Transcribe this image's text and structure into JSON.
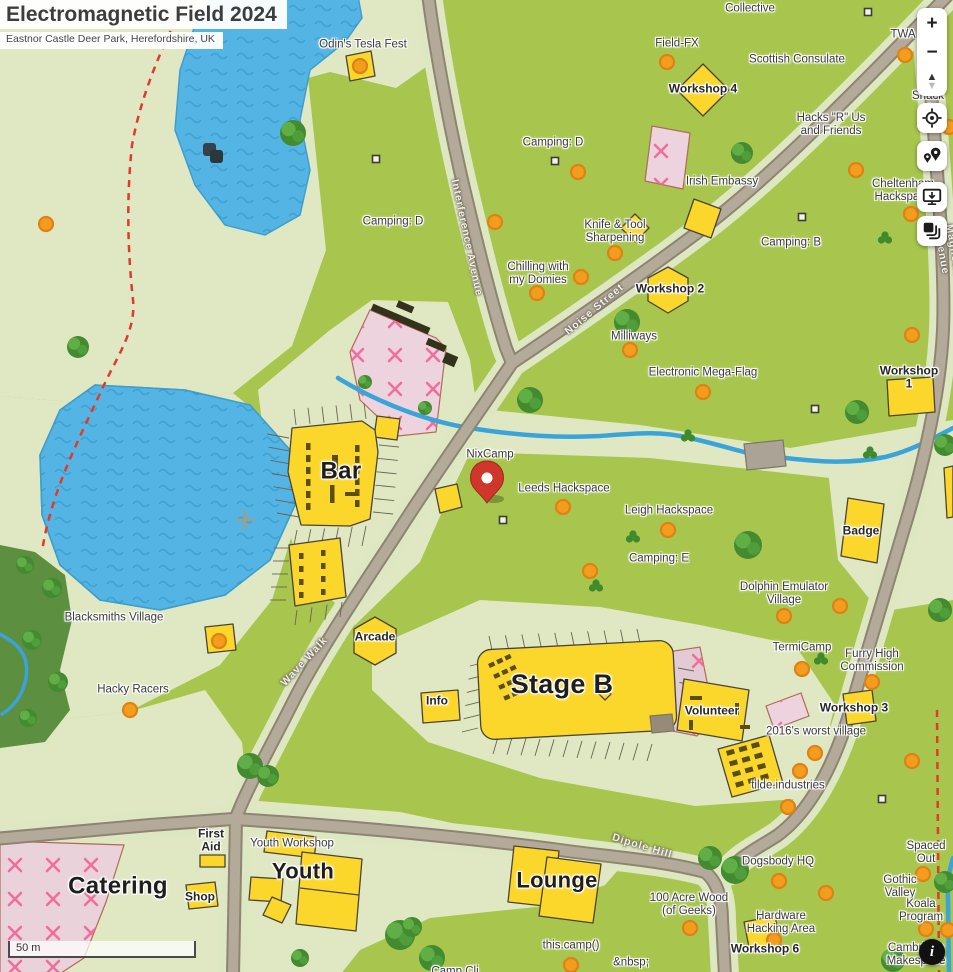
{
  "title": {
    "main": "Electromagnetic Field 2024",
    "subtitle": "Eastnor Castle Deer Park, Herefordshire, UK"
  },
  "scale_bar": {
    "label": "50 m"
  },
  "controls": {
    "zoom_in": "+",
    "zoom_out": "−",
    "compass_up": "▲",
    "compass_down": "▼",
    "locate": "locate-icon",
    "pins": "map-pins-icon",
    "export": "screen-export-icon",
    "layers": "layers-icon",
    "info": "i"
  },
  "marker": {
    "name": "red-map-pin",
    "x": 487,
    "y": 497
  },
  "colors": {
    "grass": "#a8c64d",
    "pale": "#dfe8c3",
    "water": "#54b4e4",
    "road": "#b3aa9a",
    "road_casing": "#8e8472",
    "building_yellow": "#fcd72b",
    "pink_area": "#ecd3de",
    "pink_x": "#ef6e9b",
    "orange_dot": "#f49c1e",
    "pin_red": "#ce3729",
    "red_dash": "#e2392b",
    "forest": "#5c8f3f"
  },
  "labels": [
    {
      "id": "odins-tesla-fest",
      "text": "Odin's Tesla Fest",
      "x": 363,
      "y": 45,
      "cls": "reg"
    },
    {
      "id": "collective",
      "text": "Collective",
      "x": 750,
      "y": 9,
      "cls": "reg"
    },
    {
      "id": "field-fx",
      "text": "Field-FX",
      "x": 677,
      "y": 44,
      "cls": "reg"
    },
    {
      "id": "scottish-consulate",
      "text": "Scottish Consulate",
      "x": 797,
      "y": 60,
      "cls": "reg"
    },
    {
      "id": "twa",
      "text": "TWA",
      "x": 903,
      "y": 35,
      "cls": "reg"
    },
    {
      "id": "hacks-r-us",
      "text": "Hacks \"R\" Us\nand Friends",
      "x": 831,
      "y": 125,
      "cls": "reg"
    },
    {
      "id": "shack",
      "text": "Shack (",
      "x": 928,
      "y": 103,
      "cls": "reg"
    },
    {
      "id": "camping-d-west",
      "text": "Camping: D",
      "x": 393,
      "y": 222,
      "cls": "reg"
    },
    {
      "id": "camping-d-east",
      "text": "Camping: D",
      "x": 553,
      "y": 143,
      "cls": "reg"
    },
    {
      "id": "irish-embassy",
      "text": "Irish Embassy",
      "x": 722,
      "y": 182,
      "cls": "reg"
    },
    {
      "id": "camping-b",
      "text": "Camping: B",
      "x": 791,
      "y": 243,
      "cls": "reg"
    },
    {
      "id": "knife-tool-sharpening",
      "text": "Knife & Tool\nSharpening",
      "x": 615,
      "y": 232,
      "cls": "reg"
    },
    {
      "id": "chilling-with-my-domies",
      "text": "Chilling with\nmy Domies",
      "x": 538,
      "y": 274,
      "cls": "reg"
    },
    {
      "id": "milliways",
      "text": "Milliways",
      "x": 634,
      "y": 337,
      "cls": "reg"
    },
    {
      "id": "electronic-mega-flag",
      "text": "Electronic Mega-Flag",
      "x": 703,
      "y": 373,
      "cls": "reg"
    },
    {
      "id": "cheltenham-hackspace",
      "text": "Cheltenham\nHackspace",
      "x": 903,
      "y": 191,
      "cls": "reg"
    },
    {
      "id": "nixcamp",
      "text": "NixCamp",
      "x": 490,
      "y": 455,
      "cls": "reg"
    },
    {
      "id": "leeds-hackspace",
      "text": "Leeds Hackspace",
      "x": 564,
      "y": 489,
      "cls": "reg"
    },
    {
      "id": "leigh-hackspace",
      "text": "Leigh Hackspace",
      "x": 669,
      "y": 511,
      "cls": "reg"
    },
    {
      "id": "camping-e",
      "text": "Camping: E",
      "x": 659,
      "y": 559,
      "cls": "reg"
    },
    {
      "id": "dolphin-emulator-village",
      "text": "Dolphin Emulator\nVillage",
      "x": 784,
      "y": 594,
      "cls": "reg"
    },
    {
      "id": "termicamp",
      "text": "TermiCamp",
      "x": 802,
      "y": 648,
      "cls": "reg"
    },
    {
      "id": "furry-high-commission",
      "text": "Furry High\nCommission",
      "x": 872,
      "y": 661,
      "cls": "reg"
    },
    {
      "id": "blacksmiths-village",
      "text": "Blacksmiths Village",
      "x": 114,
      "y": 618,
      "cls": "reg"
    },
    {
      "id": "hacky-racers",
      "text": "Hacky Racers",
      "x": 133,
      "y": 690,
      "cls": "reg"
    },
    {
      "id": "worst-village-2016",
      "text": "2016's worst village",
      "x": 816,
      "y": 732,
      "cls": "reg"
    },
    {
      "id": "tilde-industries",
      "text": "tilde.industries",
      "x": 788,
      "y": 786,
      "cls": "reg"
    },
    {
      "id": "dogsbody-hq",
      "text": "Dogsbody HQ",
      "x": 778,
      "y": 862,
      "cls": "reg"
    },
    {
      "id": "spaced-out",
      "text": "Spaced Out",
      "x": 926,
      "y": 853,
      "cls": "reg"
    },
    {
      "id": "gothic-valley",
      "text": "Gothic Valley",
      "x": 900,
      "y": 887,
      "cls": "reg"
    },
    {
      "id": "koala-program",
      "text": "Koala Program",
      "x": 921,
      "y": 911,
      "cls": "reg"
    },
    {
      "id": "hundred-acre-wood",
      "text": "100 Acre Wood\n(of Geeks)",
      "x": 689,
      "y": 905,
      "cls": "reg"
    },
    {
      "id": "hardware-hacking-area",
      "text": "Hardware\nHacking Area",
      "x": 781,
      "y": 923,
      "cls": "reg"
    },
    {
      "id": "this-camp",
      "text": "this.camp()",
      "x": 571,
      "y": 946,
      "cls": "reg"
    },
    {
      "id": "nbsp",
      "text": "&nbsp;",
      "x": 631,
      "y": 963,
      "cls": "reg"
    },
    {
      "id": "camp-cli",
      "text": "Camp Cli",
      "x": 455,
      "y": 972,
      "cls": "reg"
    },
    {
      "id": "cambridge-makespace",
      "text": "Cambridge\nMakespace",
      "x": 916,
      "y": 955,
      "cls": "reg"
    },
    {
      "id": "youth-workshop",
      "text": "Youth Workshop",
      "x": 292,
      "y": 844,
      "cls": "reg"
    },
    {
      "id": "workshop-4",
      "text": "Workshop 4",
      "x": 703,
      "y": 89,
      "cls": "b"
    },
    {
      "id": "workshop-2",
      "text": "Workshop 2",
      "x": 670,
      "y": 289,
      "cls": "b"
    },
    {
      "id": "workshop-1",
      "text": "Workshop 1",
      "x": 909,
      "y": 378,
      "cls": "b"
    },
    {
      "id": "workshop-3",
      "text": "Workshop 3",
      "x": 854,
      "y": 708,
      "cls": "b"
    },
    {
      "id": "workshop-6",
      "text": "Workshop 6",
      "x": 765,
      "y": 949,
      "cls": "b"
    },
    {
      "id": "badge",
      "text": "Badge",
      "x": 861,
      "y": 531,
      "cls": "b"
    },
    {
      "id": "arcade",
      "text": "Arcade",
      "x": 375,
      "y": 637,
      "cls": "b"
    },
    {
      "id": "info",
      "text": "Info",
      "x": 437,
      "y": 701,
      "cls": "b"
    },
    {
      "id": "volunteer",
      "text": "Volunteer",
      "x": 712,
      "y": 711,
      "cls": "b"
    },
    {
      "id": "first-aid",
      "text": "First\nAid",
      "x": 211,
      "y": 841,
      "cls": "b"
    },
    {
      "id": "shop",
      "text": "Shop",
      "x": 200,
      "y": 897,
      "cls": "b"
    },
    {
      "id": "bar",
      "text": "Bar",
      "x": 341,
      "y": 472,
      "cls": "big",
      "fs": 24
    },
    {
      "id": "stage-b",
      "text": "Stage B",
      "x": 562,
      "y": 684,
      "cls": "big",
      "fs": 27
    },
    {
      "id": "youth",
      "text": "Youth",
      "x": 303,
      "y": 872,
      "cls": "big",
      "fs": 22
    },
    {
      "id": "lounge",
      "text": "Lounge",
      "x": 557,
      "y": 881,
      "cls": "big",
      "fs": 22
    },
    {
      "id": "catering",
      "text": "Catering",
      "x": 118,
      "y": 887,
      "cls": "big",
      "fs": 24
    },
    {
      "id": "interference-avenue",
      "text": "Interference Avenue",
      "x": 466,
      "y": 238,
      "cls": "street",
      "rot": 78
    },
    {
      "id": "noise-street",
      "text": "Noise Street",
      "x": 595,
      "y": 310,
      "cls": "street",
      "rot": -40
    },
    {
      "id": "wave-walk",
      "text": "Wave Walk",
      "x": 305,
      "y": 662,
      "cls": "street",
      "rot": -47
    },
    {
      "id": "dipole-hill",
      "text": "Dipole Hill",
      "x": 642,
      "y": 847,
      "cls": "street",
      "rot": 17
    },
    {
      "id": "magnetic-avenue",
      "text": "Magnetic Avenue",
      "x": 947,
      "y": 252,
      "cls": "street",
      "rot": 80
    }
  ]
}
